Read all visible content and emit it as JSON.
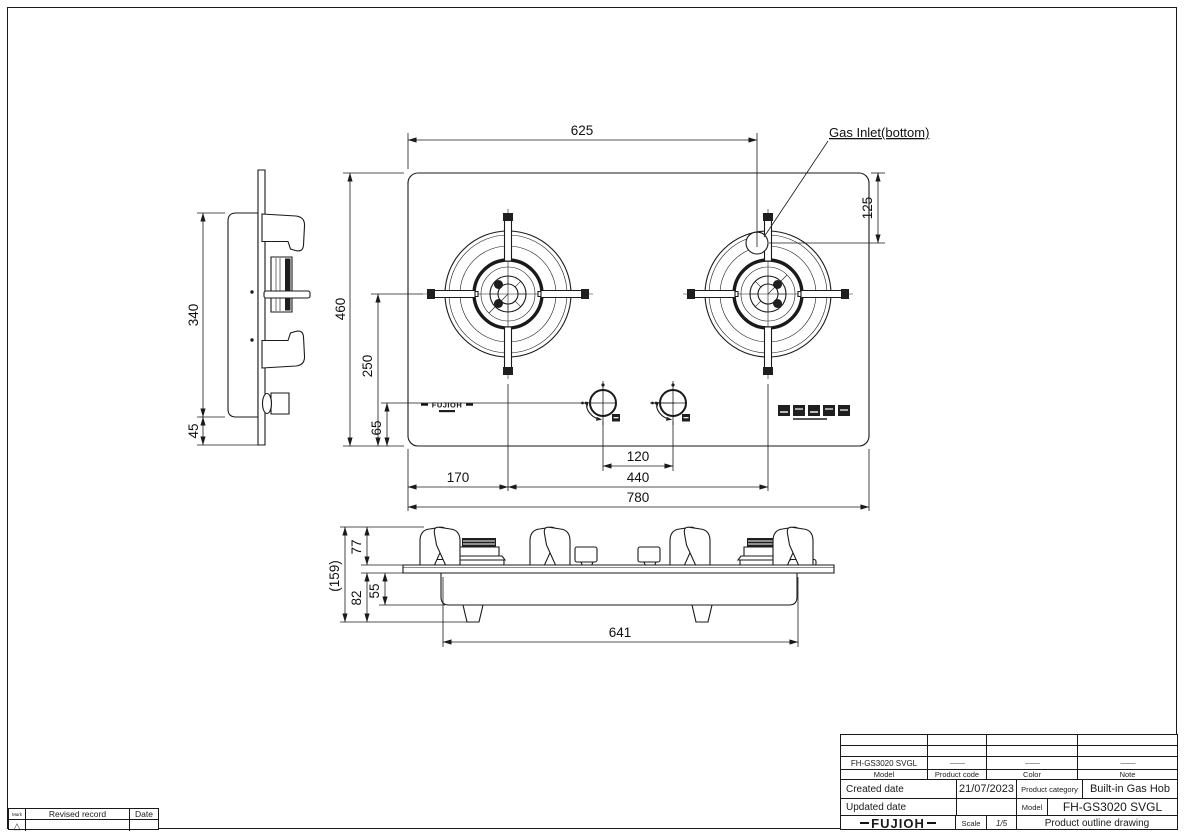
{
  "drawing": {
    "callout_gas_inlet": "Gas Inlet(bottom)",
    "panel_logo": "FUJIOH",
    "top_view": {
      "dim_width_to_inlet": "625",
      "dim_inlet_from_rear": "125",
      "dim_depth": "460",
      "dim_burner_center_from_front": "250",
      "dim_knob_center_from_front": "65",
      "dim_knob_spacing": "120",
      "dim_edge_to_burner": "170",
      "dim_burner_spacing": "440",
      "dim_overall_width": "780"
    },
    "side_view": {
      "dim_depth": "340",
      "dim_front_overhang": "45"
    },
    "front_view": {
      "dim_overall_height": "(159)",
      "dim_height_above_top": "77",
      "dim_height_below_top": "82",
      "dim_body_height": "55",
      "dim_body_width": "641"
    }
  },
  "revision_table": {
    "mark_header": "Mark",
    "record_header": "Revised record",
    "date_header": "Date",
    "mark_symbol": "△"
  },
  "title_block": {
    "model_value": "FH-GS3020 SVGL",
    "product_code_dash": "——",
    "color_dash": "——",
    "note_dash": "——",
    "model_label": "Model",
    "product_code_label": "Product code",
    "color_label": "Color",
    "note_label": "Note",
    "created_date_label": "Created date",
    "created_date_value": "21/07/2023",
    "product_category_label": "Product category",
    "product_category_value": "Built-in Gas Hob",
    "updated_date_label": "Updated date",
    "updated_date_value": "",
    "model2_label": "Model",
    "model2_value": "FH-GS3020 SVGL",
    "brand": "FUJIOH",
    "scale_label": "Scale",
    "scale_value": "1/5",
    "drawing_title": "Product outline drawing"
  }
}
